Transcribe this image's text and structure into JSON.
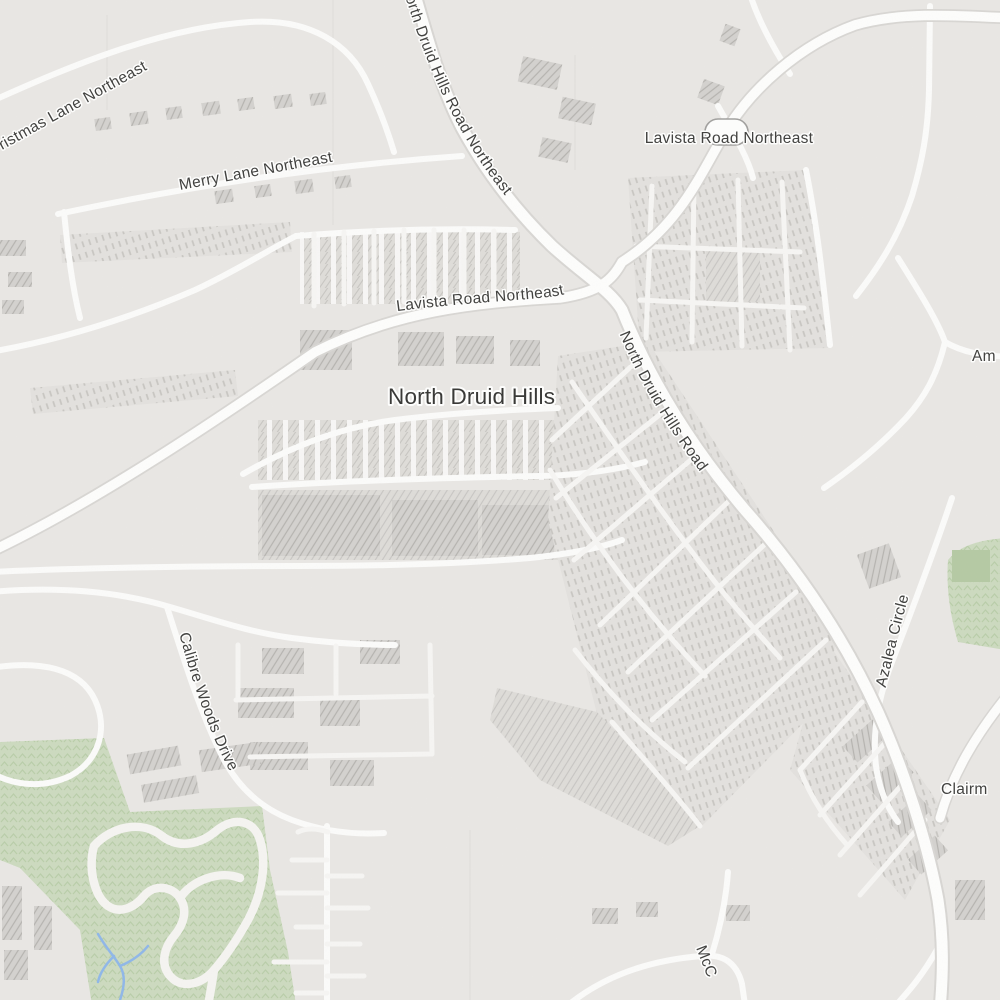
{
  "map": {
    "place_label": {
      "text": "North Druid Hills"
    },
    "road_labels": {
      "christmas_lane_partial": "ristmas Lane Northeast",
      "merry_lane": "Merry Lane Northeast",
      "north_druid_hills_road_northeast": "North Druid Hills Road Northeast",
      "lavista_road_top": "Lavista Road Northeast",
      "lavista_road_mid": "Lavista Road Northeast",
      "north_druid_hills_road": "North Druid Hills Road",
      "azalea_circle": "Azalea Circle",
      "calibre_woods_drive": "Calibre Woods Drive",
      "clairmont_partial": "Clairm",
      "mcconnell_partial": "McC",
      "am_partial": "Am"
    },
    "route_shield": {
      "text": ""
    },
    "colors": {
      "background": "#e9e7e4",
      "road_fill": "#fdfdfc",
      "road_casing": "#d8d6d3",
      "hatch_light_bg": "#dedcd8",
      "hatch_line": "#c7c5c2",
      "hatch_dark_bg": "#d3d1ce",
      "park": "#ccdabf",
      "park_texture": "#b9cda8",
      "park_dark_patch": "#b5c9a3",
      "water": "#8fb7e8",
      "label_text": "#424240",
      "label_halo": "#fdfdfc"
    }
  }
}
